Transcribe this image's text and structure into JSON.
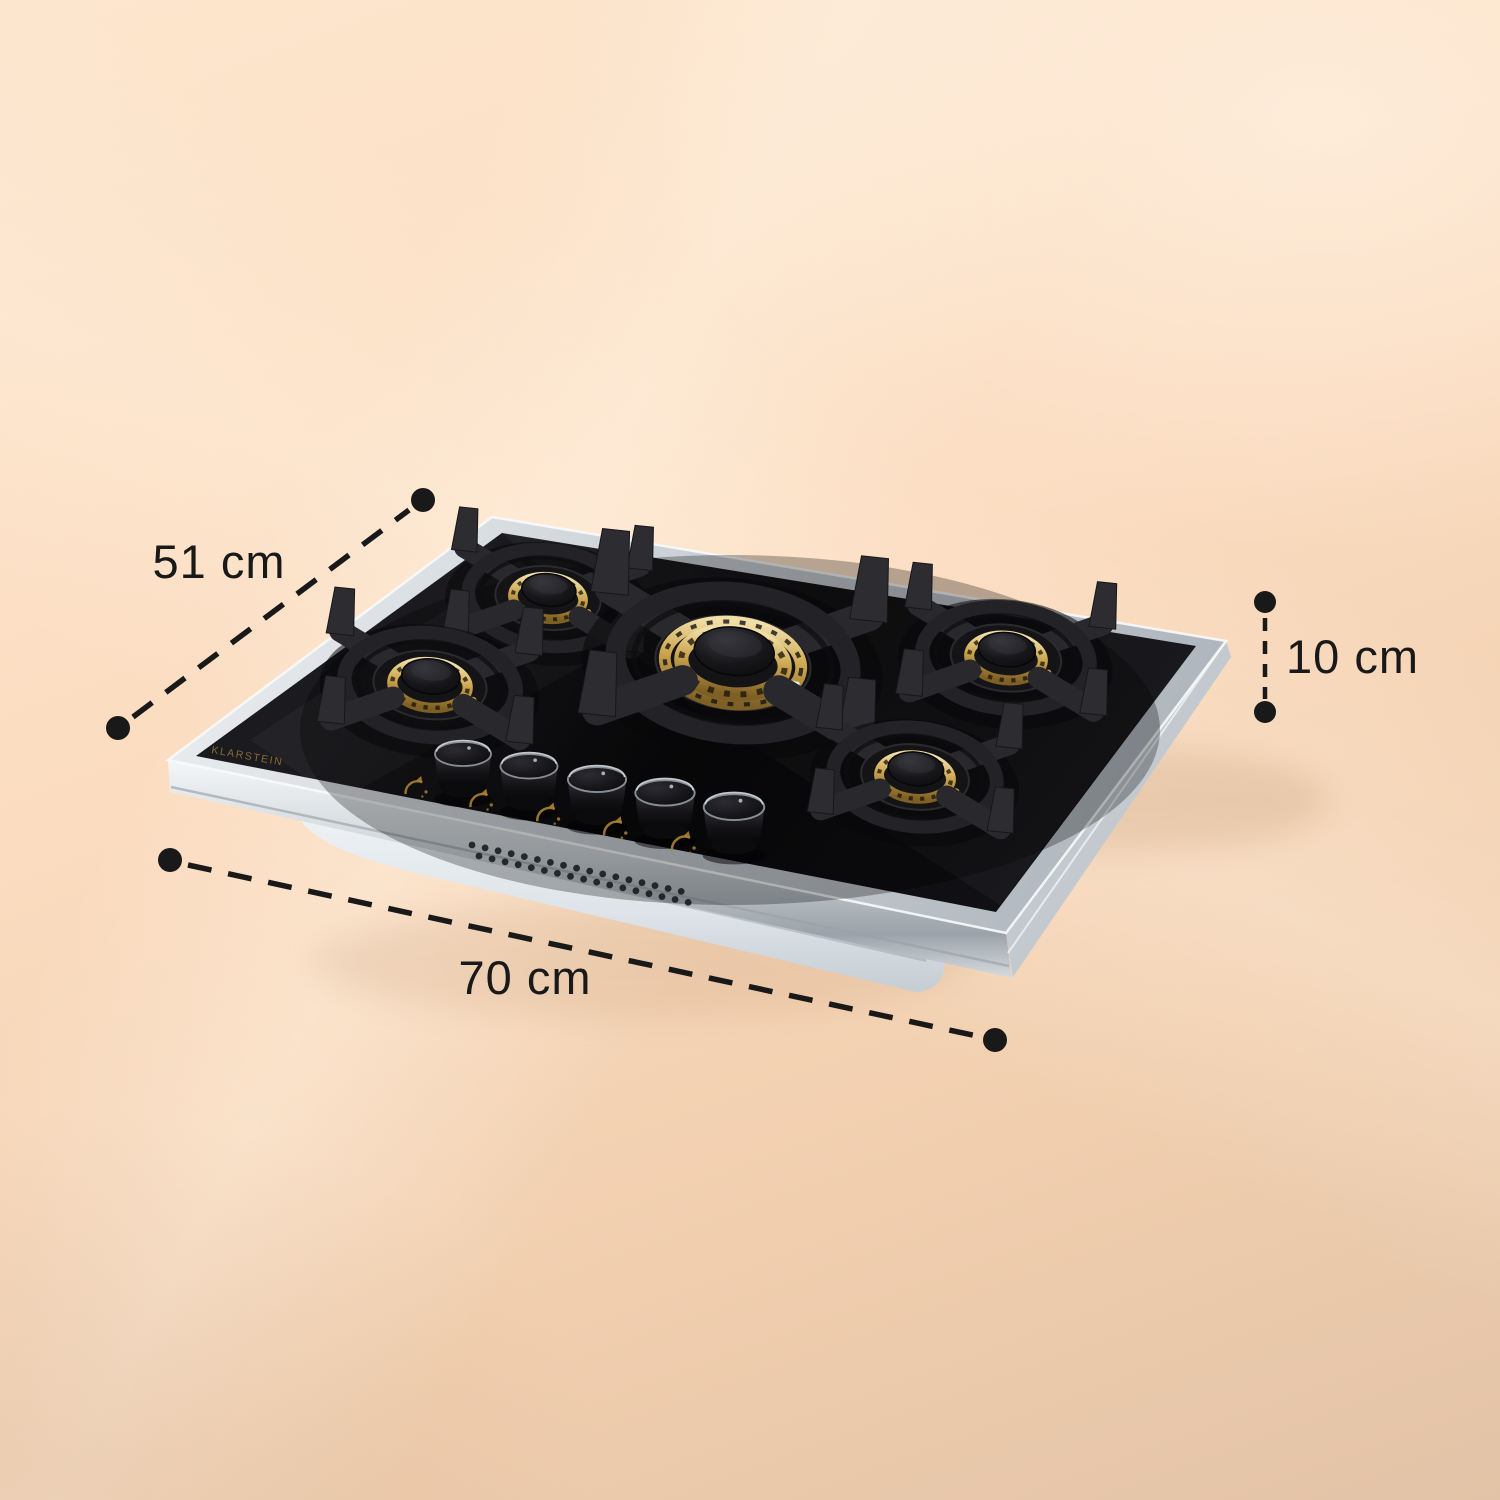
{
  "brand": "KLARSTEIN",
  "dimensions": {
    "depth": {
      "label": "51 cm"
    },
    "height": {
      "label": "10 cm"
    },
    "width": {
      "label": "70 cm"
    }
  },
  "hob": {
    "burner_count": 5,
    "control_knob_count": 5,
    "vent_hole_rows": 2,
    "vent_holes_per_row": 17
  },
  "colors": {
    "background_top": "#fde6ce",
    "background_bottom": "#e3c3a7",
    "annotation_ink": "#191919",
    "glass_black": "#0b0b0d",
    "steel_silver": "#ccd1d6",
    "brass_gold": "#c29d4e",
    "brand_gold": "#8d6f36",
    "underside_white": "#e9edf0"
  }
}
